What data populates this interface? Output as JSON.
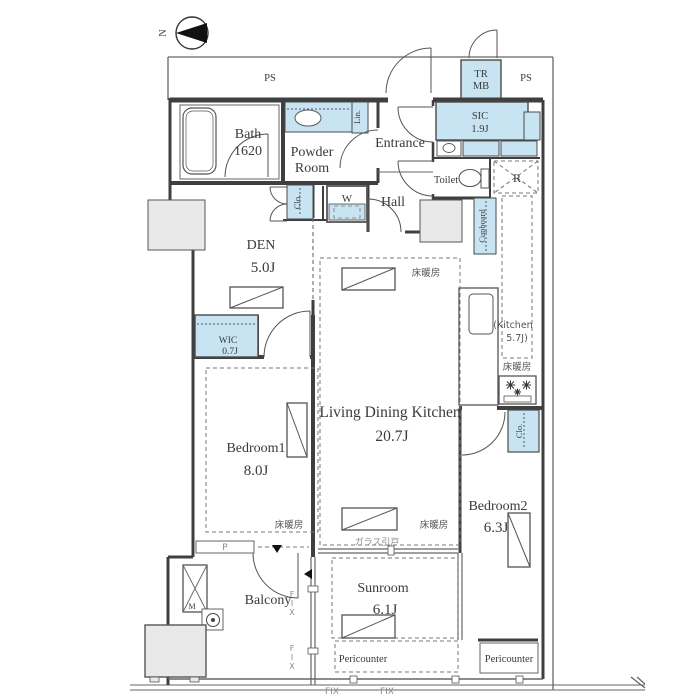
{
  "compass": {
    "north": "N"
  },
  "colors": {
    "wall": "#3f3f3f",
    "fixture_blue": "#c8e4f2",
    "gray_fill": "#e9e9e9",
    "text": "#3a3a3a"
  },
  "rooms": {
    "bath": {
      "name": "Bath",
      "size": "1620"
    },
    "powder_room": {
      "line1": "Powder",
      "line2": "Room"
    },
    "entrance": {
      "name": "Entrance"
    },
    "sic": {
      "name": "SIC",
      "size": "1.9J"
    },
    "toilet": {
      "name": "Toilet"
    },
    "hall": {
      "name": "Hall"
    },
    "den": {
      "name": "DEN",
      "size": "5.0J"
    },
    "wic": {
      "name": "WIC",
      "size": "0.7J"
    },
    "bedroom1": {
      "name": "Bedroom1",
      "size": "8.0J"
    },
    "ldk": {
      "name": "Living Dining Kitchen",
      "size": "20.7J"
    },
    "kitchen": {
      "name": "(Kitchen",
      "size": "5.7J)"
    },
    "bedroom2": {
      "name": "Bedroom2",
      "size": "6.3J"
    },
    "sunroom": {
      "name": "Sunroom",
      "size": "6.1J"
    },
    "balcony": {
      "name": "Balcony"
    }
  },
  "fixtures": {
    "linen": "Lin.",
    "den_closet": "Clo.",
    "bedroom2_closet": "Clo.",
    "cupboard": "Cupboard",
    "washer": "W",
    "fridge": "R",
    "meter": "M",
    "pipe": "P",
    "tr": "TR",
    "mb": "MB",
    "ps_left": "PS",
    "ps_right": "PS"
  },
  "annotations": {
    "floor_heating": "床暖房",
    "glass_door": "ガラス引戸",
    "fix": "FIX",
    "pericounter_left": "Pericounter",
    "pericounter_right": "Pericounter"
  }
}
